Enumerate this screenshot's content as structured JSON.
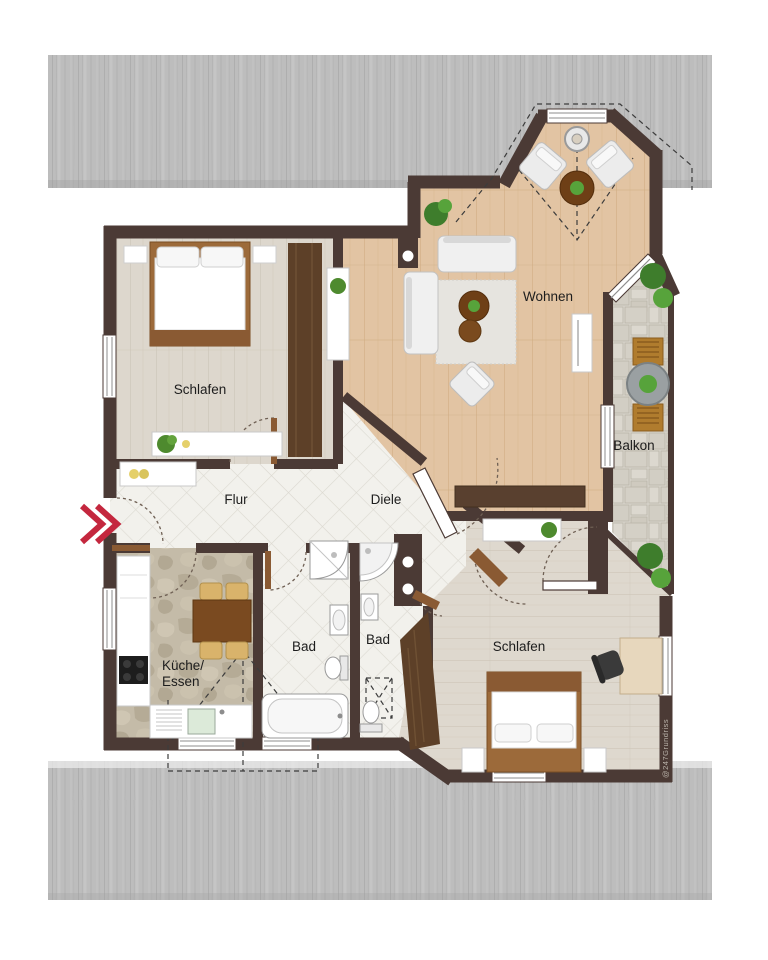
{
  "floorplan": {
    "rooms": {
      "bedroom1": {
        "label": "Schlafen"
      },
      "living": {
        "label": "Wohnen"
      },
      "balcony": {
        "label": "Balkon"
      },
      "hall": {
        "label": "Flur"
      },
      "vestibule": {
        "label": "Diele"
      },
      "kitchen": {
        "label_line1": "Küche/",
        "label_line2": "Essen"
      },
      "bath1": {
        "label": "Bad"
      },
      "bath2": {
        "label": "Bad"
      },
      "bedroom2": {
        "label": "Schlafen"
      }
    },
    "watermark": "@247Grundriss",
    "icons": [
      "entrance-arrow-icon",
      "plant-icon",
      "ceiling-lamp-icon"
    ],
    "colors": {
      "wall": "#4b3a35",
      "roof_band": "#bdbdbd",
      "wood_warm": "#e2c4a3",
      "wood_grey": "#ddd6cc",
      "tile": "#f2f1ec",
      "stone_kitchen": "#c4bba8",
      "stone_balcony": "#d8d4cb",
      "accent_red": "#c4273e",
      "furniture_brown": "#8a5a33"
    }
  }
}
